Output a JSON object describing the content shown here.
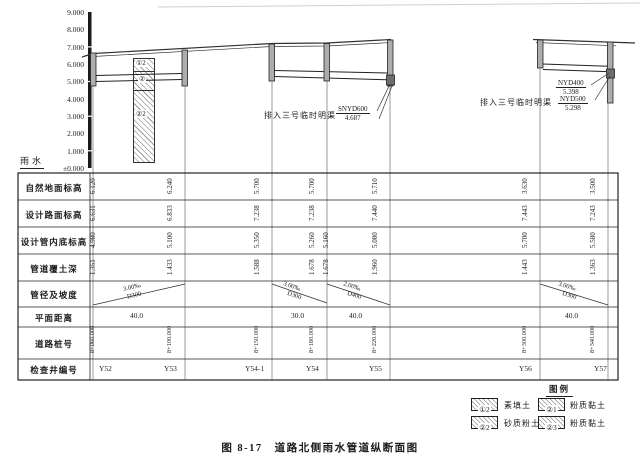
{
  "axis": {
    "unit_label": "雨水",
    "ticks": [
      "9.000",
      "8.000",
      "7.000",
      "6.000",
      "5.000",
      "4.000",
      "3.000",
      "2.000",
      "1.000",
      "±0.000"
    ]
  },
  "profile": {
    "borehole_layers": [
      "①2",
      "②",
      "②2"
    ],
    "outfall_left": {
      "channel": "排入三号临时明渠",
      "pipe": "SNYD600",
      "invert": "4.687"
    },
    "outfall_right": {
      "channel": "排入三号临时明渠",
      "pipes": [
        {
          "name": "NYD400",
          "invert": "5.398"
        },
        {
          "name": "NYD500",
          "invert": "5.298"
        }
      ]
    }
  },
  "table": {
    "row_labels": [
      "自然地面标高",
      "设计路面标高",
      "设计管内底标高",
      "管道覆土深",
      "管径及坡度",
      "平面距离",
      "道路桩号",
      "检查井编号"
    ],
    "columns": [
      {
        "id": "Y52",
        "ground": "6.120",
        "road": "6.631",
        "invert": "4.980",
        "cover": "1.351",
        "stake": "8+060.000"
      },
      {
        "id": "Y53",
        "ground": "6.240",
        "road": "6.833",
        "invert": "5.100",
        "cover": "1.433",
        "stake": "8+100.000"
      },
      {
        "id": "Y54-1",
        "ground": "5.700",
        "road": "7.238",
        "invert": "5.350",
        "cover": "1.588",
        "stake": "8+150.000"
      },
      {
        "id": "Y54",
        "ground": "5.700",
        "road": "7.238",
        "invert": "5.260",
        "invert2": "5.160",
        "cover": "1.678",
        "cover2": "1.678",
        "stake": "8+180.000"
      },
      {
        "id": "Y55",
        "ground": "5.710",
        "road": "7.440",
        "invert": "5.080",
        "cover": "1.960",
        "stake": "8+220.000"
      },
      {
        "id": "Y56",
        "ground": "3.630",
        "road": "7.443",
        "invert": "5.700",
        "cover": "1.443",
        "stake": "8+300.000"
      },
      {
        "id": "Y57",
        "ground": "3.500",
        "road": "7.243",
        "invert": "5.580",
        "cover": "1.363",
        "stake": "8+340.000"
      }
    ],
    "segments": [
      {
        "slope": "3.00‰",
        "diameter": "D300",
        "distance": "40.0"
      },
      {
        "slope": "3.00‰",
        "diameter": "D300",
        "distance": "30.0"
      },
      {
        "slope": "2.00‰",
        "diameter": "D400",
        "distance": "40.0"
      },
      {
        "slope": "3.00‰",
        "diameter": "D300",
        "distance": "40.0"
      }
    ]
  },
  "legend": {
    "title": "图例",
    "items": [
      {
        "symbol": "①2",
        "label": "素填土"
      },
      {
        "symbol": "②1",
        "label": "粉质黏土"
      },
      {
        "symbol": "②2",
        "label": "砂质粉土"
      },
      {
        "symbol": "②3",
        "label": "粉质黏土"
      }
    ]
  },
  "caption": "图 8-17　道路北侧雨水管道纵断面图"
}
